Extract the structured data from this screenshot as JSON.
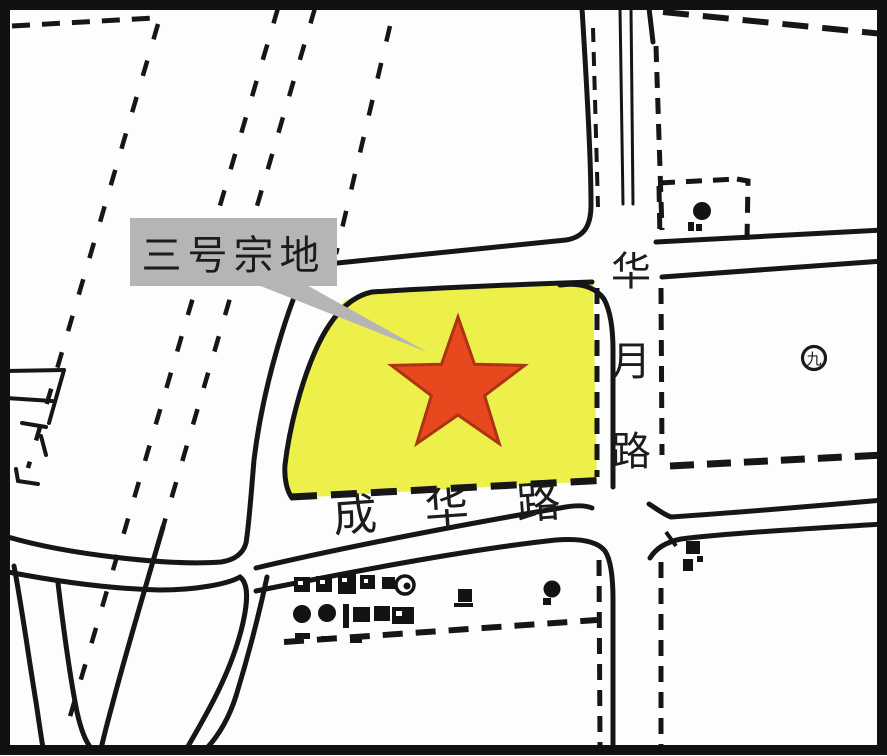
{
  "map": {
    "title_label": "三号宗地",
    "roads": {
      "vertical": "华月路",
      "horizontal": "成华路"
    },
    "landmark_symbol": "九",
    "colors": {
      "parcel_fill": "#EDEF4B",
      "star_fill": "#E8481D",
      "star_stroke": "#AB3415",
      "callout_bg": "#B5B5B5",
      "line": "#161616"
    }
  }
}
